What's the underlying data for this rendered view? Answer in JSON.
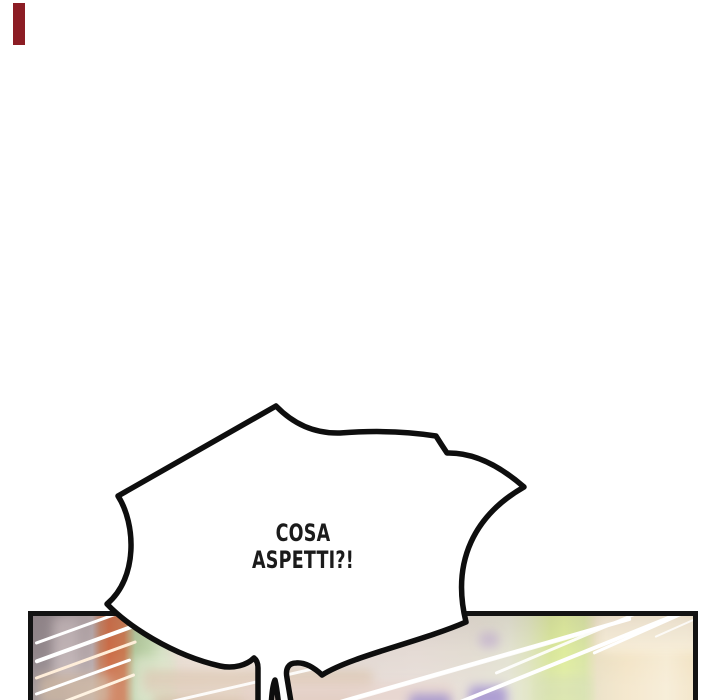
{
  "comic": {
    "bubble": {
      "line1": "COSA",
      "line2": "ASPETTI?!"
    },
    "colors": {
      "bubble_fill": "#ffffff",
      "bubble_outline": "#0e0e0e",
      "text": "#1b1b1b",
      "panel_border": "#131313",
      "streak": "#ffffff",
      "red_mark": "#8c1d24",
      "photo_mauve": "#978c8f",
      "photo_orange": "#cc6c46",
      "photo_green": "#b3cb9e",
      "photo_yellow_green": "#dfec9e",
      "photo_cream": "#f4e6cb",
      "photo_purple": "#a18fcc"
    }
  }
}
